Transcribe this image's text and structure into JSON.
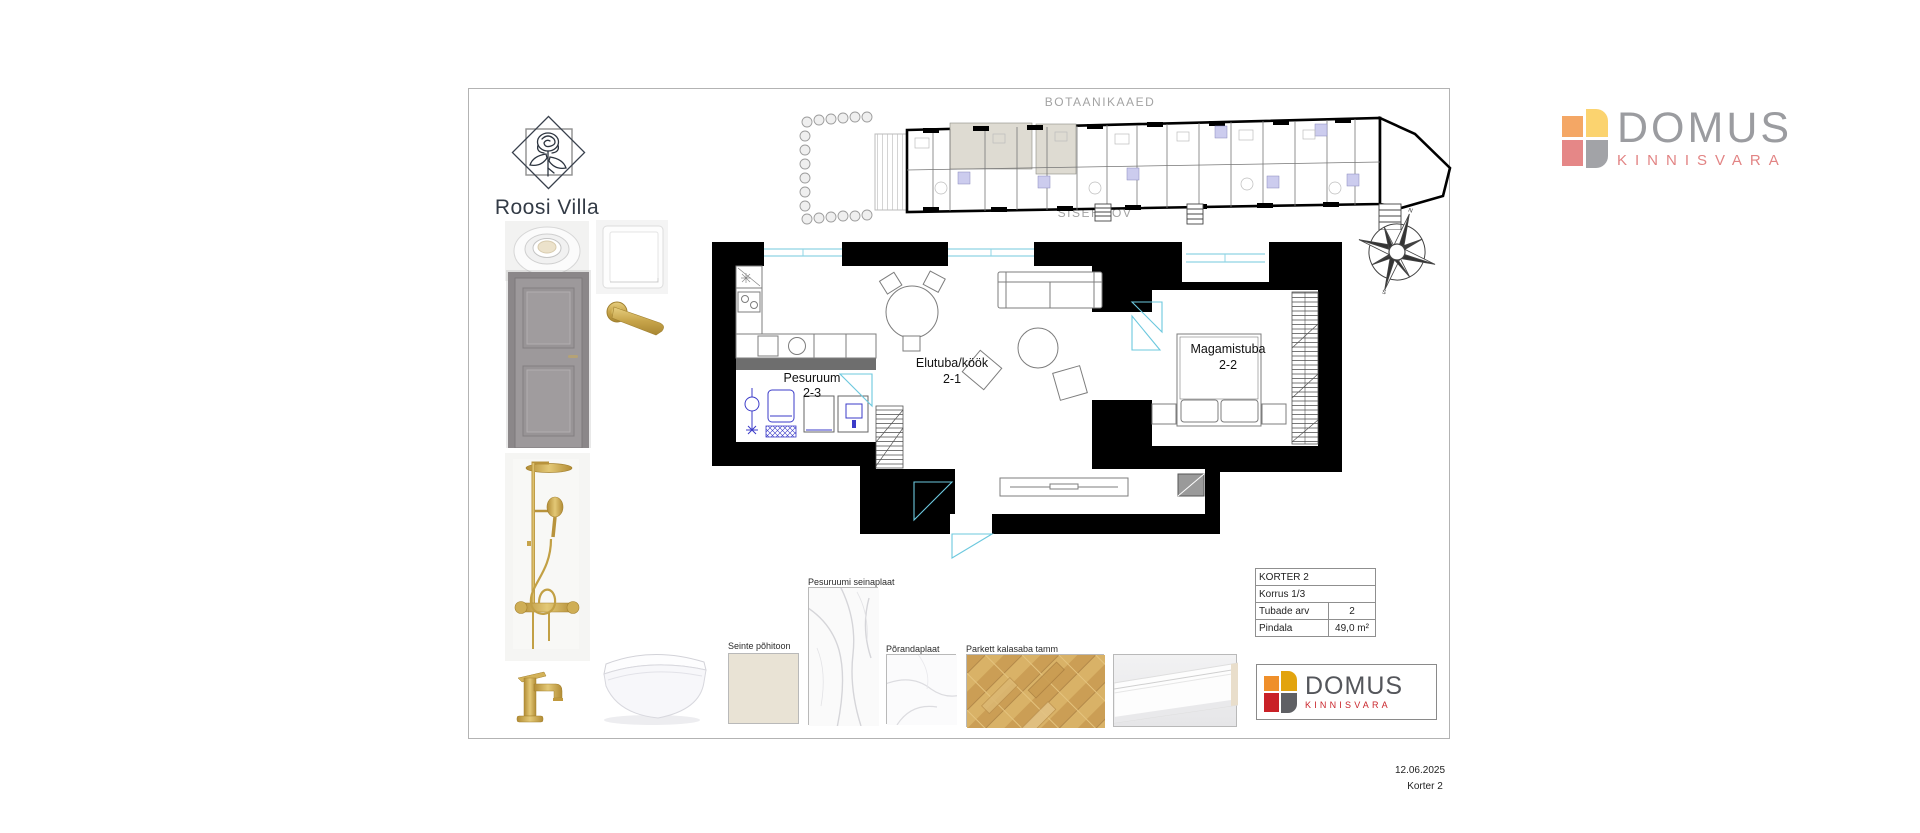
{
  "board": {
    "site": {
      "top_label": "BOTAANIKAAED",
      "bottom_label": "SISEHOOV"
    },
    "roosi": {
      "name": "Roosi Villa"
    },
    "rooms": [
      {
        "name": "Elutuba/köök",
        "code": "2-1"
      },
      {
        "name": "Magamistuba",
        "code": "2-2"
      },
      {
        "name": "Pesuruum",
        "code": "2-3"
      }
    ],
    "materials": {
      "wall_tile": "Pesuruumi seinaplaat",
      "wall_paint": "Seinte põhitoon",
      "floor_tile": "Põrandaplaat",
      "parquet": "Parkett kalasaba tamm"
    },
    "info_table": {
      "r1": "KORTER 2",
      "r2": "Korrus 1/3",
      "r3_label": "Tubade arv",
      "r3_value": "2",
      "r4_label": "Pindala",
      "r4_value": "49,0 m²"
    },
    "brand": {
      "name": "DOMUS",
      "tagline": "KINNISVARA"
    },
    "footer": {
      "date": "12.06.2025",
      "sheet": "Korter 2"
    },
    "colors": {
      "logo_orange": "#EF8F2A",
      "logo_amber": "#E2A40E",
      "logo_red": "#C92127",
      "logo_gray": "#5F6064",
      "logo_muted_orange": "#F4A765",
      "logo_muted_yellow": "#FBD36F",
      "logo_muted_pink": "#E58787",
      "logo_muted_gray": "#A2A3A7",
      "plan_cyan": "#8FD4E4",
      "fixture_blue": "#3B3BC8",
      "highlight_beige": "#DEDBD2"
    }
  }
}
